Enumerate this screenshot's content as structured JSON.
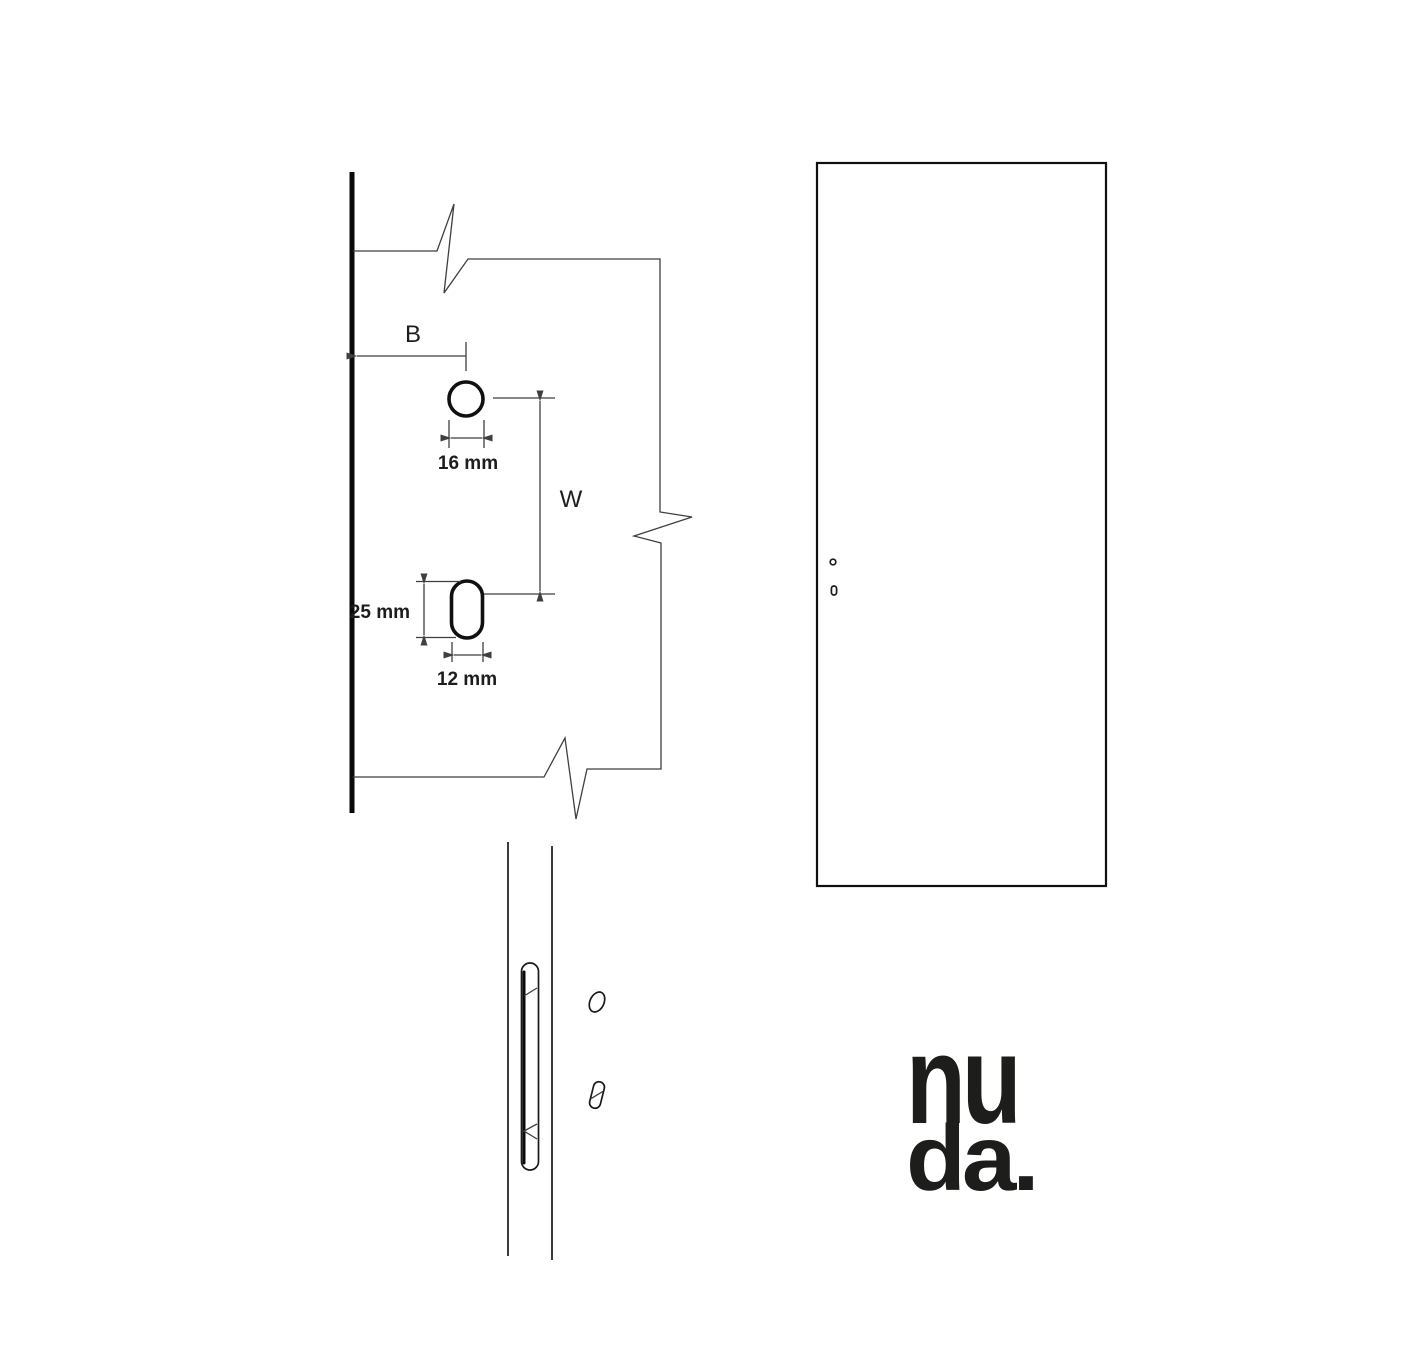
{
  "labels": {
    "offset_b": "B",
    "width_w": "W",
    "hole_diameter": "16 mm",
    "slot_length": "25 mm",
    "slot_width": "12 mm"
  },
  "logo": {
    "line1": "nu",
    "line2": "da."
  },
  "colors": {
    "background": "#ffffff",
    "thin_line": "#3f3f3f",
    "heavy_line": "#101010",
    "logo_black": "#1d1d1b"
  }
}
